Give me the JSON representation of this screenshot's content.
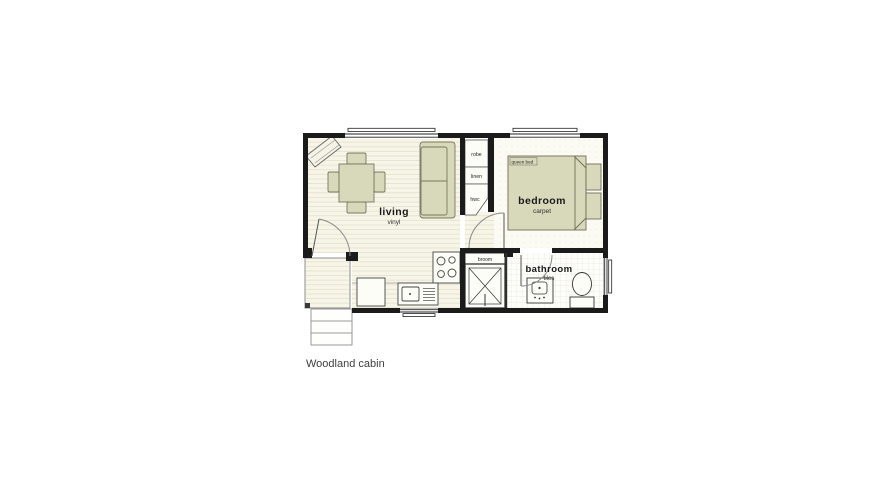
{
  "caption": "Woodland cabin",
  "plan": {
    "rooms": {
      "living": {
        "name": "living",
        "floor": "vinyl"
      },
      "bedroom": {
        "name": "bedroom",
        "floor": "carpet"
      },
      "bathroom": {
        "name": "bathroom",
        "floor": "tiles"
      }
    },
    "closets": {
      "robe": "robe",
      "linen": "linen",
      "hwc": "hwc",
      "broom": "broom"
    },
    "bed_label": "queen bed"
  },
  "colors": {
    "wall": "#1b1b1b",
    "furniture_fill": "#d8d9ba",
    "furniture_stroke": "#77775f",
    "floor_cream": "#f7f5e7",
    "plank_line": "#e5e1cf",
    "door_arc": "#8a8a8a"
  }
}
